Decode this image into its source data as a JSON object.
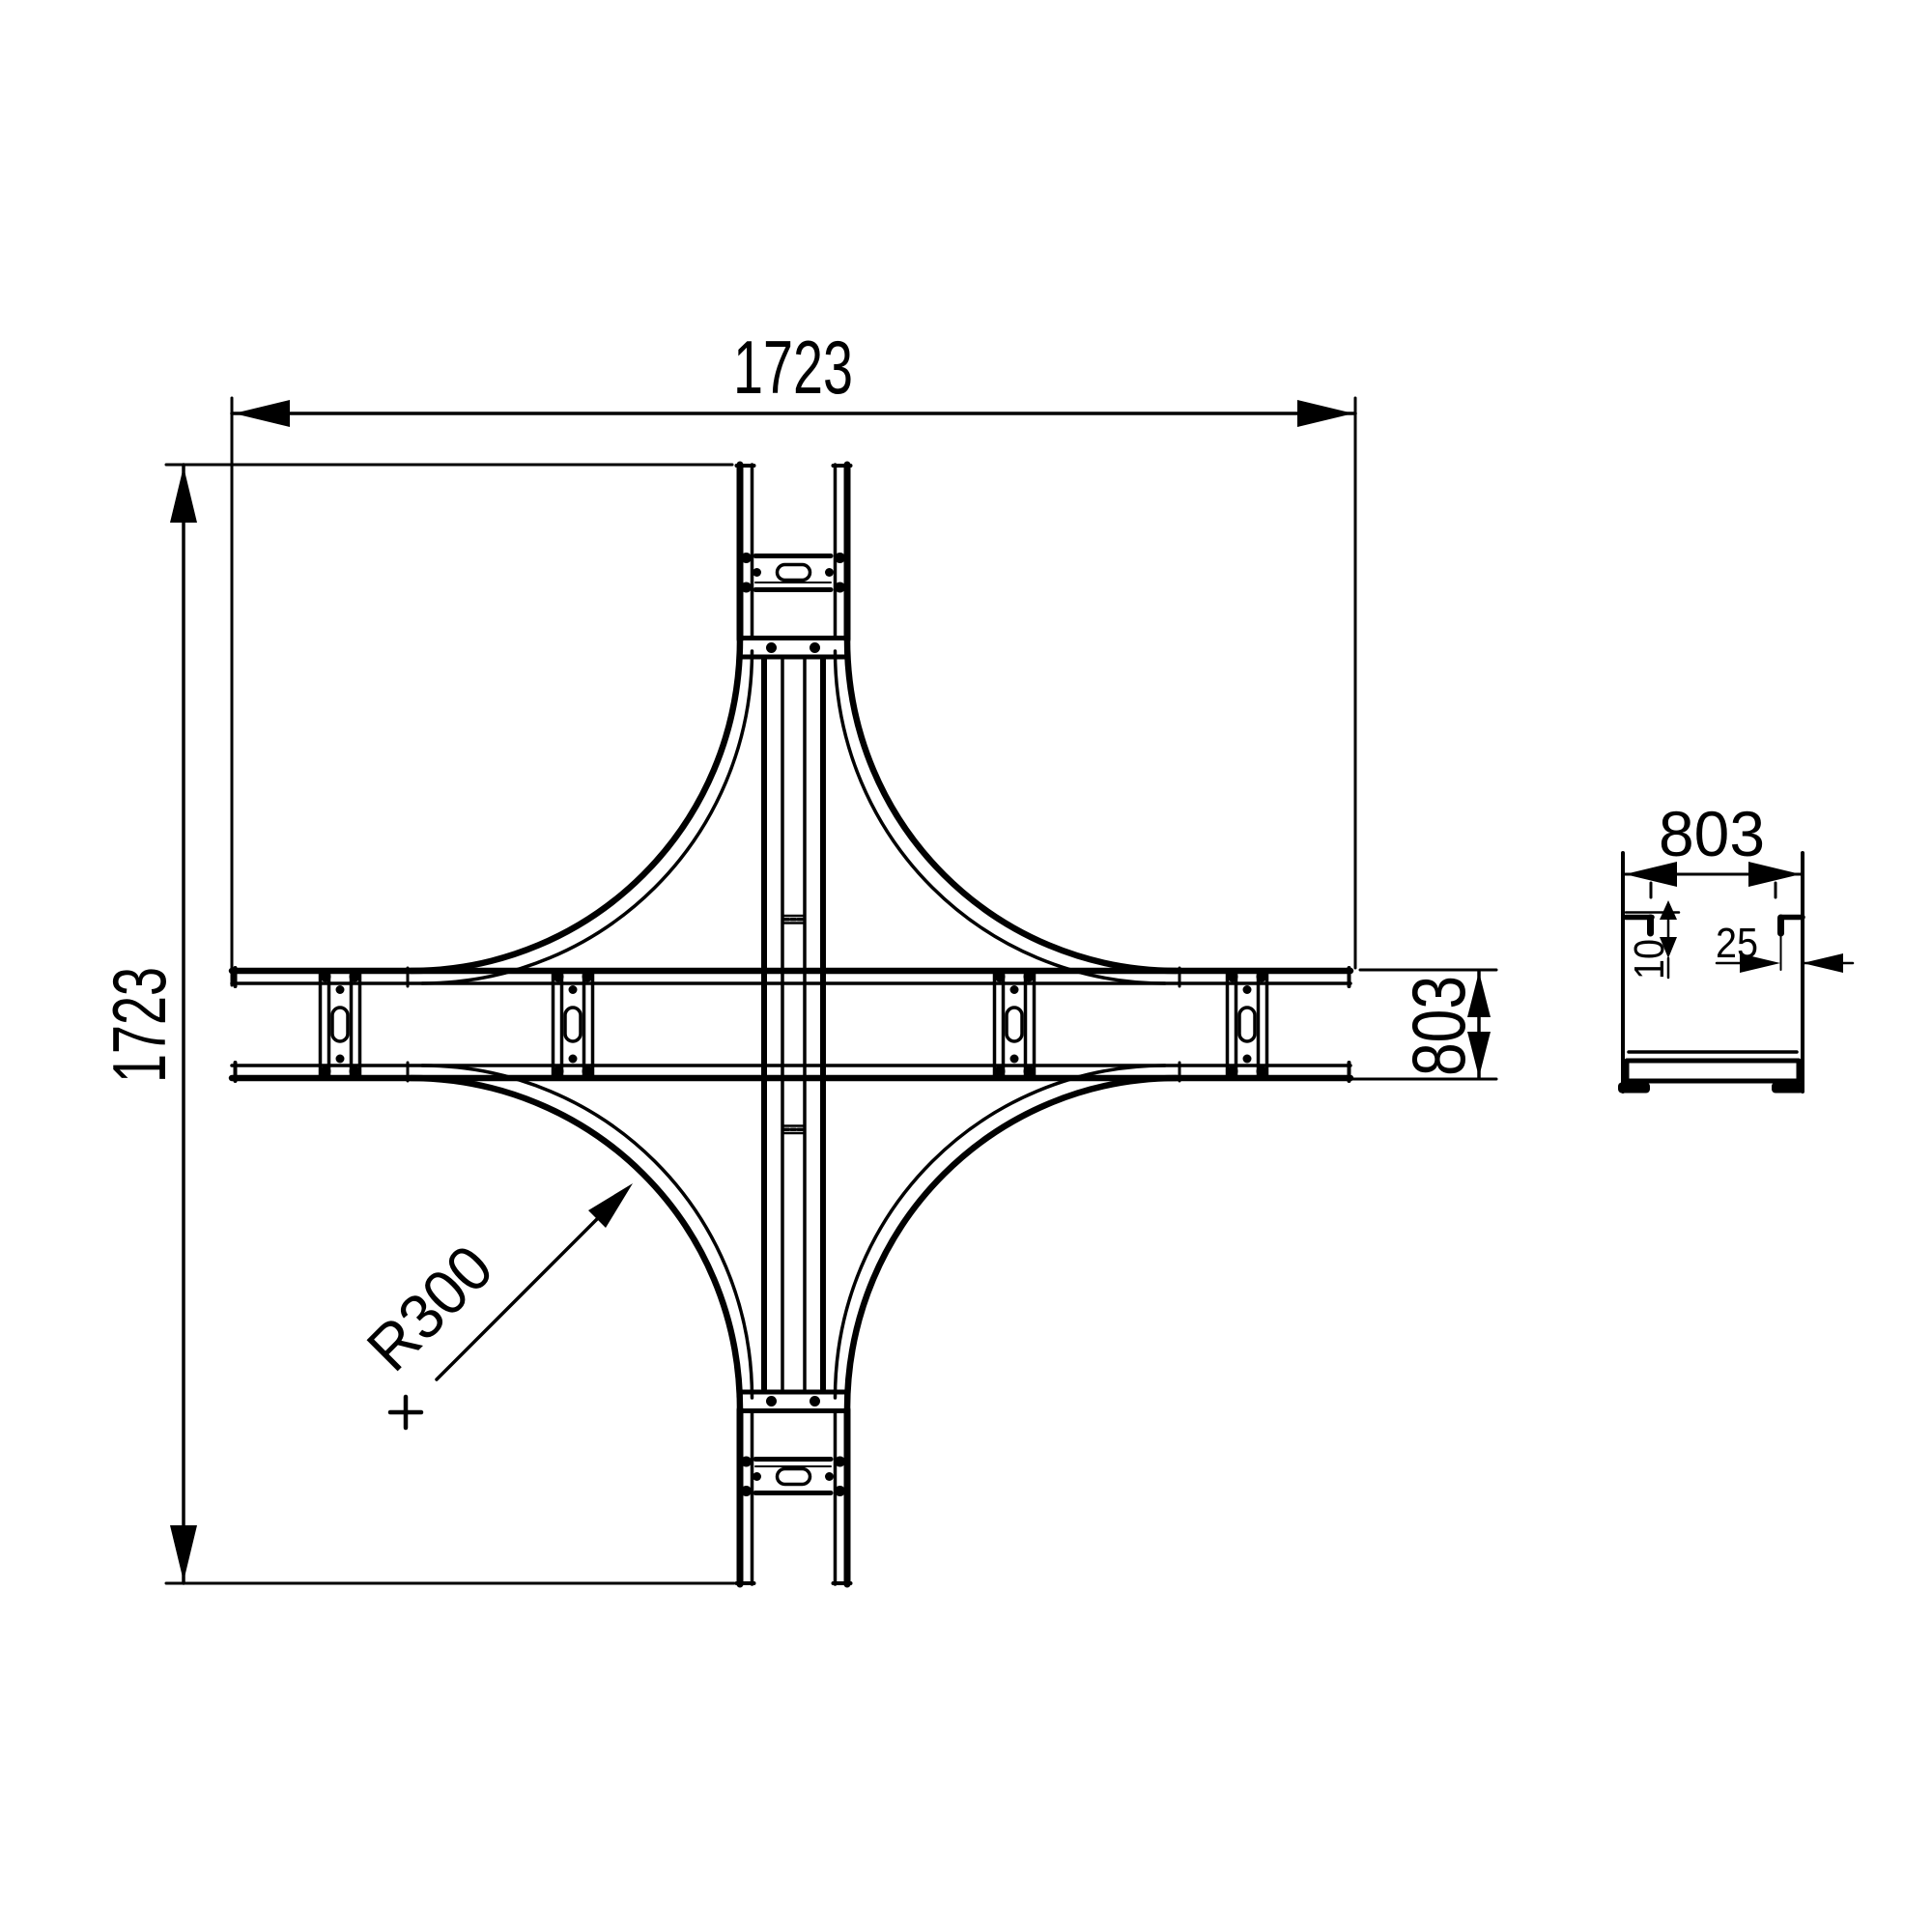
{
  "drawing": {
    "kind": "technical-dimension-drawing",
    "views": [
      "plan-cross",
      "section-channel"
    ],
    "colors": {
      "line": "#000000",
      "background": "#ffffff"
    }
  },
  "labels": {
    "overall_width": "1723",
    "overall_height": "1723",
    "arm_width": "803",
    "fillet_radius": "R300",
    "section_width": "803",
    "section_lip": "10",
    "section_edge": "25"
  }
}
